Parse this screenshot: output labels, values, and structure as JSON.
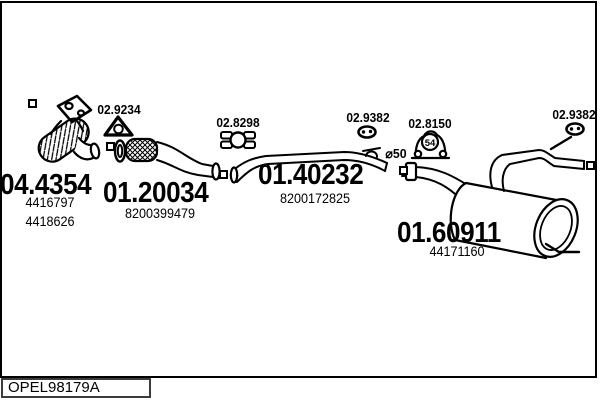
{
  "colors": {
    "line": "#000000",
    "background": "#ffffff"
  },
  "footer": {
    "drawing_code": "OPEL98179A"
  },
  "labels": {
    "gasket_code": "02.9234",
    "clamp_front_code": "02.8298",
    "hanger_mid_code": "02.9382",
    "clamp_rear_code": "02.8150",
    "clamp_rear_size": "54",
    "hanger_tail_code": "02.9382",
    "diameter_note": "⌀50"
  },
  "parts": {
    "catalytic_converter": {
      "code": "04.4354",
      "oe_1": "4416797",
      "oe_2": "4418626"
    },
    "front_flex_pipe": {
      "code": "01.20034",
      "oe": "8200399479"
    },
    "centre_pipe": {
      "code": "01.40232",
      "oe": "8200172825"
    },
    "rear_silencer": {
      "code": "01.60911",
      "oe": "44171160"
    }
  }
}
